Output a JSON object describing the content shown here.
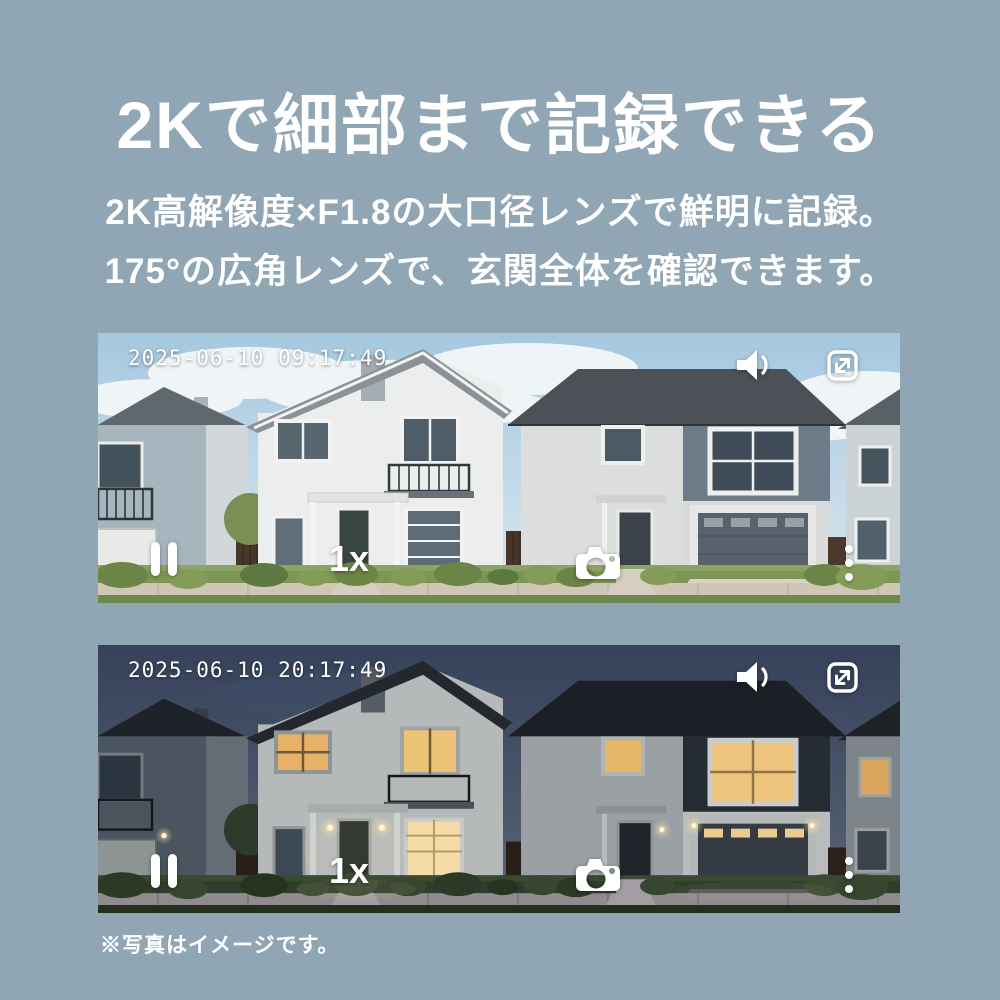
{
  "header": {
    "title": "2Kで細部まで記録できる",
    "subtitle1": "2K高解像度×F1.8の大口径レンズで鮮明に記録。",
    "subtitle2": "175°の広角レンズで、玄関全体を確認できます。"
  },
  "day_view": {
    "timestamp": "2025-06-10 09:17:49",
    "zoom_label": "1x",
    "scene_description": "daytime street view of two-story suburban houses with lawn, sidewalk and garage",
    "controls": {
      "volume_icon": "speaker-with-sound-wave",
      "fullscreen_icon": "rounded-square-expand-arrows",
      "pause_icon": "two-vertical-bars",
      "snapshot_icon": "camera",
      "menu_icon": "vertical-ellipsis"
    }
  },
  "night_view": {
    "timestamp": "2025-06-10 20:17:49",
    "zoom_label": "1x",
    "scene_description": "night street view of the same houses with warm lit windows and porch lights",
    "controls": {
      "volume_icon": "speaker-with-sound-wave",
      "fullscreen_icon": "rounded-square-expand-arrows",
      "pause_icon": "two-vertical-bars",
      "snapshot_icon": "camera",
      "menu_icon": "vertical-ellipsis"
    }
  },
  "footnote": "※写真はイメージです。",
  "colors": {
    "background": "#90a6b4",
    "text": "#ffffff",
    "day_sky": "#a5c8df",
    "night_sky": "#36425b",
    "lit_window": "#eec47c"
  }
}
